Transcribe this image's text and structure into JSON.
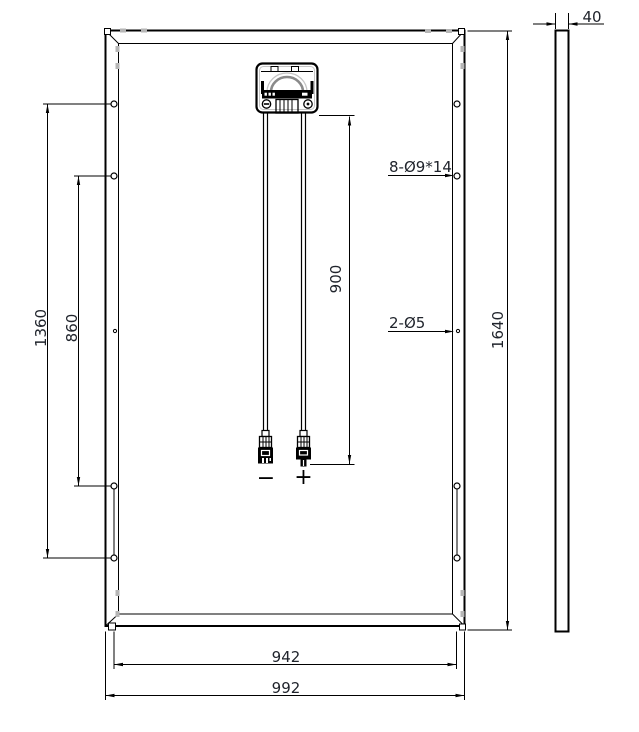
{
  "dimensions": {
    "total_height": "1640",
    "total_width": "992",
    "mounting_hole_width_span": "942",
    "mounting_hole_long_span": "1360",
    "mounting_hole_short_span": "860",
    "cable_length": "900",
    "frame_thickness": "40"
  },
  "callouts": {
    "mounting_holes": "8-Ø9*14",
    "grounding_holes": "2-Ø5"
  },
  "polarity": {
    "negative": "−",
    "positive": "+"
  },
  "colors": {
    "line": "#000000",
    "dim_text": "#20242c",
    "arch_gray": "#8a8a8a",
    "arch_light": "#c4c4c4",
    "clamp_gray": "#b6b6b6",
    "background": "#ffffff"
  }
}
